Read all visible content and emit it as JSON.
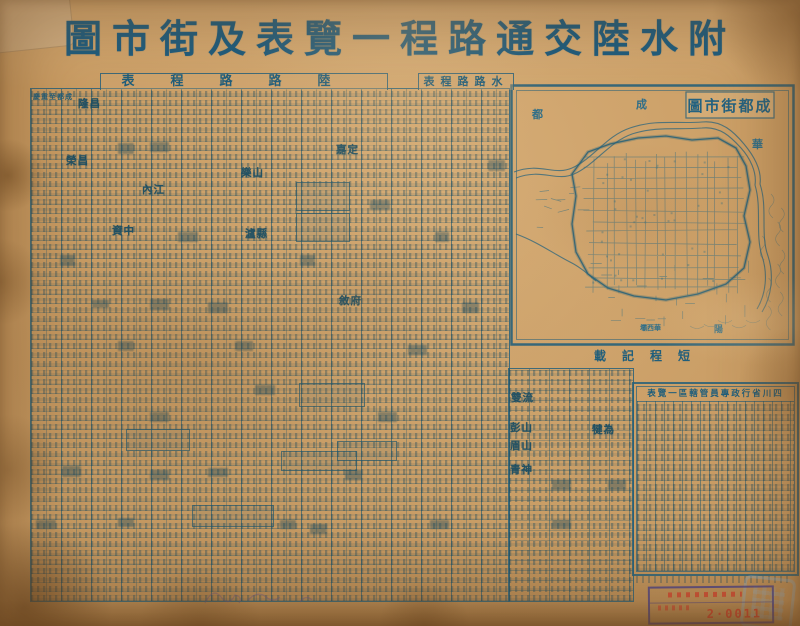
{
  "title": "附水陸交通路程一覽表及街市圖",
  "land_table": {
    "header": "陸路路程表",
    "first_route_label": "成都至重慶"
  },
  "water_table": {
    "header": "水路路程表"
  },
  "short_routes": {
    "header": "短程記載"
  },
  "admin_table": {
    "header": "四川省行政專員管轄區一覽表"
  },
  "map_inset": {
    "title": "成都街市圖",
    "edge_labels": [
      {
        "text": "都",
        "x": 22,
        "y": 22,
        "size": 11
      },
      {
        "text": "成",
        "x": 126,
        "y": 12,
        "size": 11
      },
      {
        "text": "華",
        "x": 242,
        "y": 52,
        "size": 11
      },
      {
        "text": "華西壩",
        "x": 130,
        "y": 239,
        "size": 7,
        "rtl": true
      },
      {
        "text": "陽",
        "x": 204,
        "y": 238,
        "size": 9
      }
    ]
  },
  "place_names": [
    {
      "label": "隆昌",
      "x": 78,
      "y": 96
    },
    {
      "label": "榮昌",
      "x": 66,
      "y": 153
    },
    {
      "label": "內江",
      "x": 142,
      "y": 182
    },
    {
      "label": "樂山",
      "x": 241,
      "y": 165
    },
    {
      "label": "瀘縣",
      "x": 245,
      "y": 226
    },
    {
      "label": "資中",
      "x": 112,
      "y": 223
    },
    {
      "label": "嘉定",
      "x": 336,
      "y": 142
    },
    {
      "label": "敘府",
      "x": 339,
      "y": 293
    },
    {
      "label": "雙流",
      "x": 511,
      "y": 390
    },
    {
      "label": "彭山",
      "x": 510,
      "y": 420
    },
    {
      "label": "眉山",
      "x": 510,
      "y": 438
    },
    {
      "label": "青神",
      "x": 510,
      "y": 462
    },
    {
      "label": "犍為",
      "x": 592,
      "y": 422
    }
  ],
  "stamp": {
    "number": "2·0011"
  },
  "colors": {
    "paper": "#cb9d64",
    "ink": "#1f5e7b",
    "ink_light": "#2f6e88",
    "stamp_red": "#cc4530",
    "stamp_frame": "#3c3c8e",
    "seal_blue": "#8ab4d6"
  }
}
